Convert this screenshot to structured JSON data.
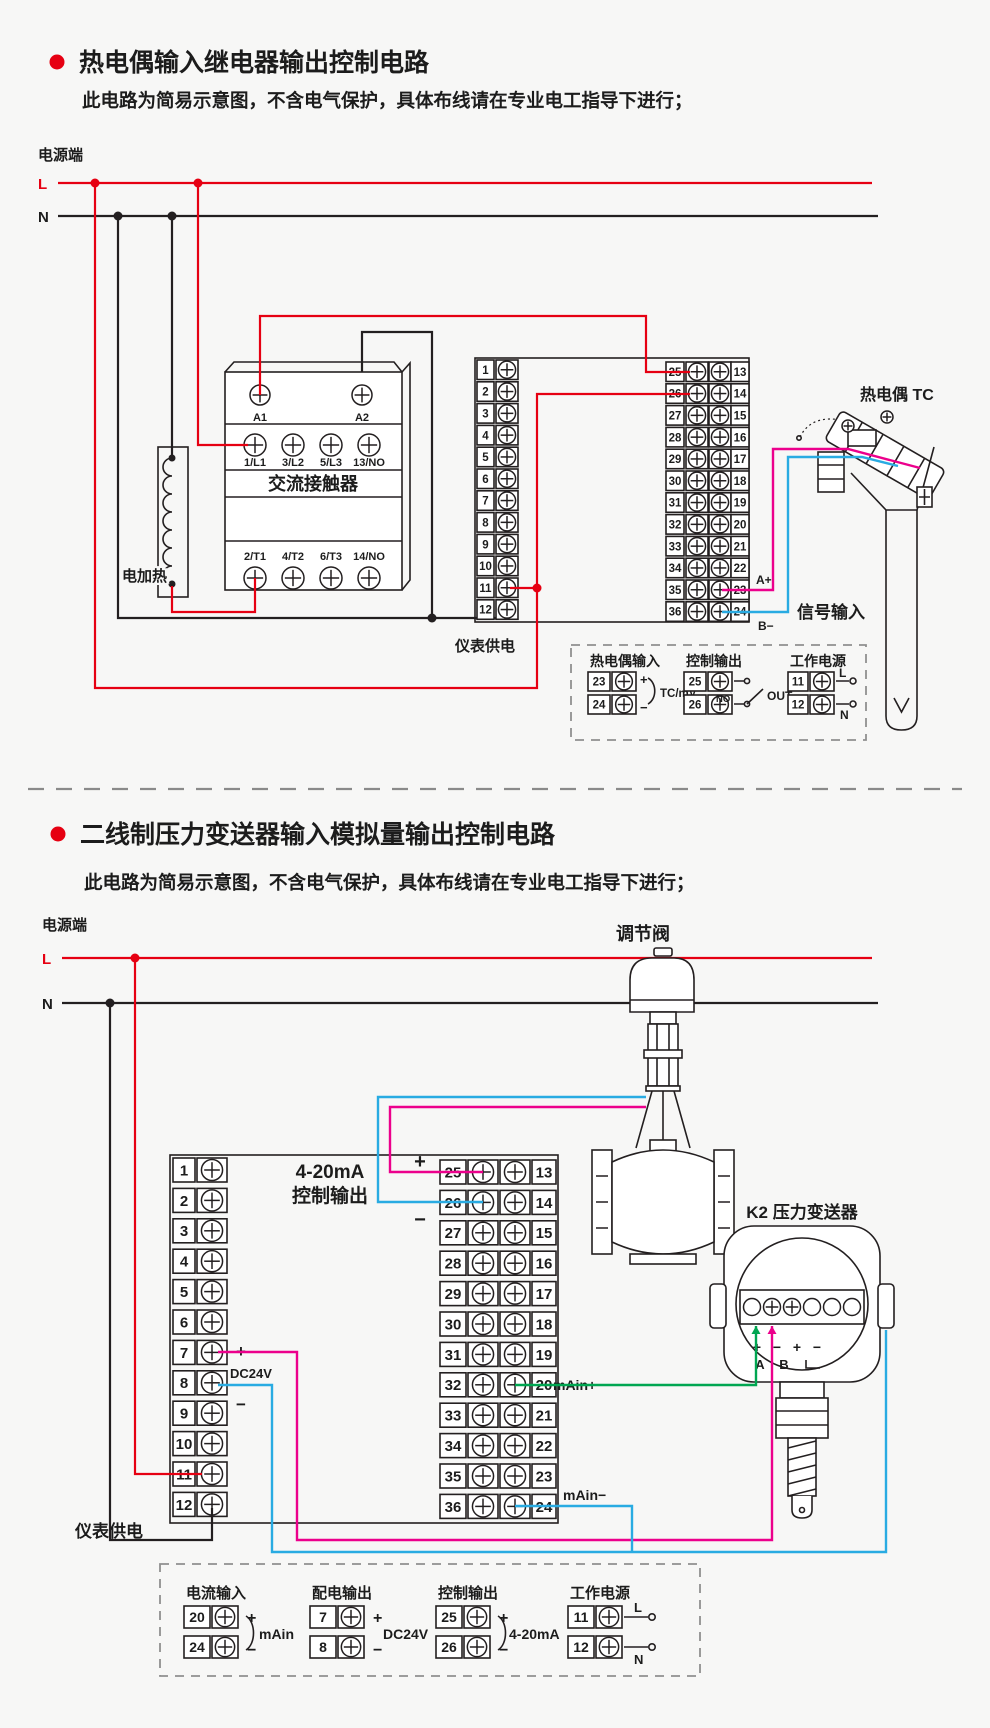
{
  "colors": {
    "accent_red": "#e60012",
    "wire_black": "#231f20",
    "wire_pink": "#ec008c",
    "wire_blue": "#29abe2",
    "wire_green": "#00a651",
    "background": "#f7f7f6"
  },
  "section1": {
    "title": "热电偶输入继电器输出控制电路",
    "subtitle": "此电路为简易示意图，不含电气保护，具体布线请在专业电工指导下进行；",
    "power": {
      "label": "电源端",
      "l": "L",
      "n": "N"
    },
    "contactor": {
      "name": "交流接触器",
      "coil": [
        "A1",
        "A2"
      ],
      "top": [
        "1/L1",
        "3/L2",
        "5/L3",
        "13/NO"
      ],
      "bottom": [
        "2/T1",
        "4/T2",
        "6/T3",
        "14/NO"
      ]
    },
    "heater": "电加热",
    "meter_power": "仪表供电",
    "terminals": {
      "left": [
        "1",
        "2",
        "3",
        "4",
        "5",
        "6",
        "7",
        "8",
        "9",
        "10",
        "11",
        "12"
      ],
      "mid": [
        "25",
        "26",
        "27",
        "28",
        "29",
        "30",
        "31",
        "32",
        "33",
        "34",
        "35",
        "36"
      ],
      "right": [
        "13",
        "14",
        "15",
        "16",
        "17",
        "18",
        "19",
        "20",
        "21",
        "22",
        "23",
        "24"
      ]
    },
    "signal": {
      "a": "A+",
      "b": "B−",
      "label": "信号输入"
    },
    "tc": "热电偶 TC",
    "legend": {
      "input": {
        "title": "热电偶输入",
        "t1": "23",
        "t2": "24",
        "p": "+",
        "m": "−",
        "note": "TC/mV"
      },
      "output": {
        "title": "控制输出",
        "t1": "25",
        "t2": "26",
        "no": "NO",
        "out": "OUT"
      },
      "power": {
        "title": "工作电源",
        "t1": "11",
        "t2": "12",
        "l": "L",
        "n": "N"
      }
    }
  },
  "section2": {
    "title": "二线制压力变送器输入模拟量输出控制电路",
    "subtitle": "此电路为简易示意图，不含电气保护，具体布线请在专业电工指导下进行；",
    "power": {
      "label": "电源端",
      "l": "L",
      "n": "N"
    },
    "meter_power": "仪表供电",
    "terminals": {
      "left": [
        "1",
        "2",
        "3",
        "4",
        "5",
        "6",
        "7",
        "8",
        "9",
        "10",
        "11",
        "12"
      ],
      "mid": [
        "25",
        "26",
        "27",
        "28",
        "29",
        "30",
        "31",
        "32",
        "33",
        "34",
        "35",
        "36"
      ],
      "right": [
        "13",
        "14",
        "15",
        "16",
        "17",
        "18",
        "19",
        "20",
        "21",
        "22",
        "23",
        "24"
      ]
    },
    "out_label": {
      "line1": "4-20mA",
      "line2": "控制输出",
      "plus": "+",
      "minus": "−"
    },
    "dc": {
      "plus": "+",
      "minus": "−",
      "label": "DC24V"
    },
    "main_plus": "mAin+",
    "main_minus": "mAin−",
    "valve": "调节阀",
    "transmitter": {
      "label": "K2 压力变送器",
      "pm": [
        "+",
        "−",
        "+",
        "−"
      ],
      "a": "A",
      "b": "B",
      "l": "L"
    },
    "legend": {
      "current": {
        "title": "电流输入",
        "t1": "20",
        "t2": "24",
        "p": "+",
        "m": "−",
        "note": "mAin"
      },
      "supply": {
        "title": "配电输出",
        "t1": "7",
        "t2": "8",
        "p": "+",
        "m": "−",
        "note": "DC24V"
      },
      "control": {
        "title": "控制输出",
        "t1": "25",
        "t2": "26",
        "p": "+",
        "m": "−",
        "note": "4-20mA"
      },
      "power": {
        "title": "工作电源",
        "t1": "11",
        "t2": "12",
        "l": "L",
        "n": "N"
      }
    }
  }
}
